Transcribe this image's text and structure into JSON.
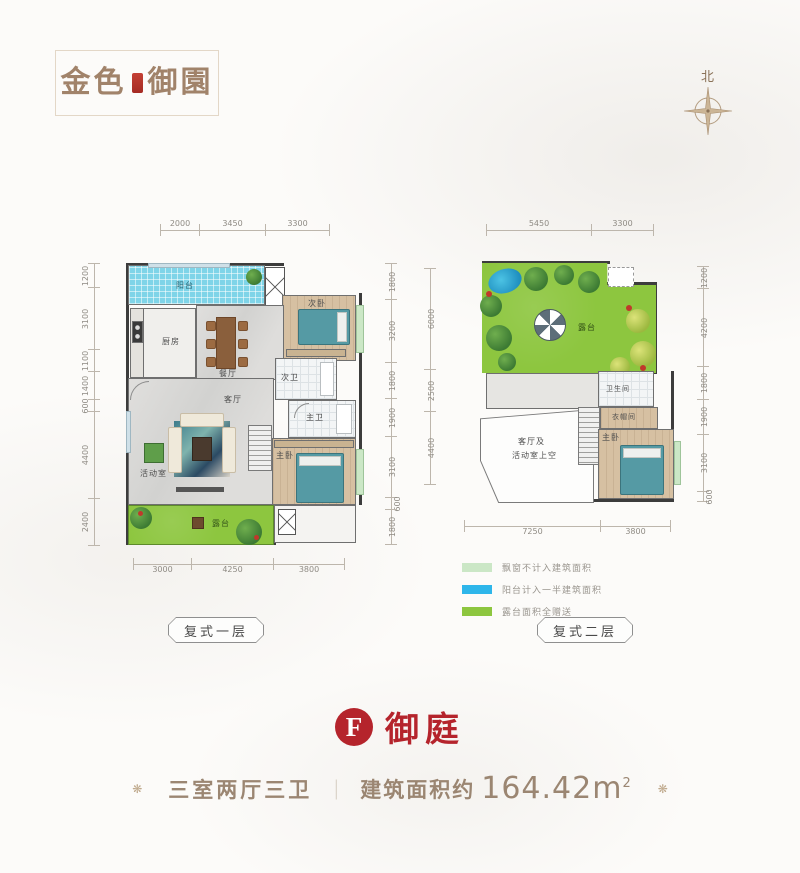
{
  "logo": {
    "text_left": "金色",
    "text_right": "御園"
  },
  "compass": {
    "label": "北"
  },
  "plan1": {
    "title": "复式一层",
    "rooms": {
      "balcony": "阳台",
      "kitchen": "厨房",
      "dining": "餐厅",
      "living": "客厅",
      "bedroom2": "次卧",
      "bath2": "次卫",
      "bath1": "主卫",
      "master": "主卧",
      "activity": "活动室",
      "terrace": "露台"
    },
    "dims_top": [
      "2000",
      "3450",
      "3300"
    ],
    "dims_bottom": [
      "3000",
      "4250",
      "3800"
    ],
    "dims_left": [
      "1200",
      "3100",
      "1100",
      "1400",
      "600",
      "4400",
      "2400"
    ],
    "dims_right": [
      "1800",
      "3200",
      "1800",
      "1900",
      "3100",
      "600",
      "1800"
    ]
  },
  "plan2": {
    "title": "复式二层",
    "rooms": {
      "terrace": "露台",
      "bath": "卫生间",
      "closet": "衣帽间",
      "master": "主卧",
      "void_line1": "客厅及",
      "void_line2": "活动室上空"
    },
    "dims_top": [
      "5450",
      "3300"
    ],
    "dims_bottom": [
      "7250",
      "3800"
    ],
    "dims_left": [
      "6000",
      "2500",
      "4400"
    ],
    "dims_right": [
      "1200",
      "4200",
      "1800",
      "1900",
      "3100",
      "600"
    ]
  },
  "legend": {
    "items": [
      {
        "color": "#cbe7c6",
        "label": "飘窗不计入建筑面积"
      },
      {
        "color": "#2eb6ea",
        "label": "阳台计入一半建筑面积"
      },
      {
        "color": "#8dc63f",
        "label": "露台面积全赠送"
      }
    ]
  },
  "unit": {
    "badge_letter": "F",
    "name": "御庭",
    "spec": "三室两厅三卫",
    "divider": "｜",
    "area_label": "建筑面积约",
    "area_value": "164.42",
    "area_unit": "m",
    "area_sup": "2",
    "rosette": "❋"
  },
  "colors": {
    "accent_red": "#b5242c",
    "brand_tan": "#a1836a",
    "terrace_green": "#8dc63f",
    "balcony_blue": "#7fd4e8",
    "bed_teal": "#559aa4",
    "bay_green": "#cbe7c6",
    "dim_gray": "#8f8b84"
  }
}
